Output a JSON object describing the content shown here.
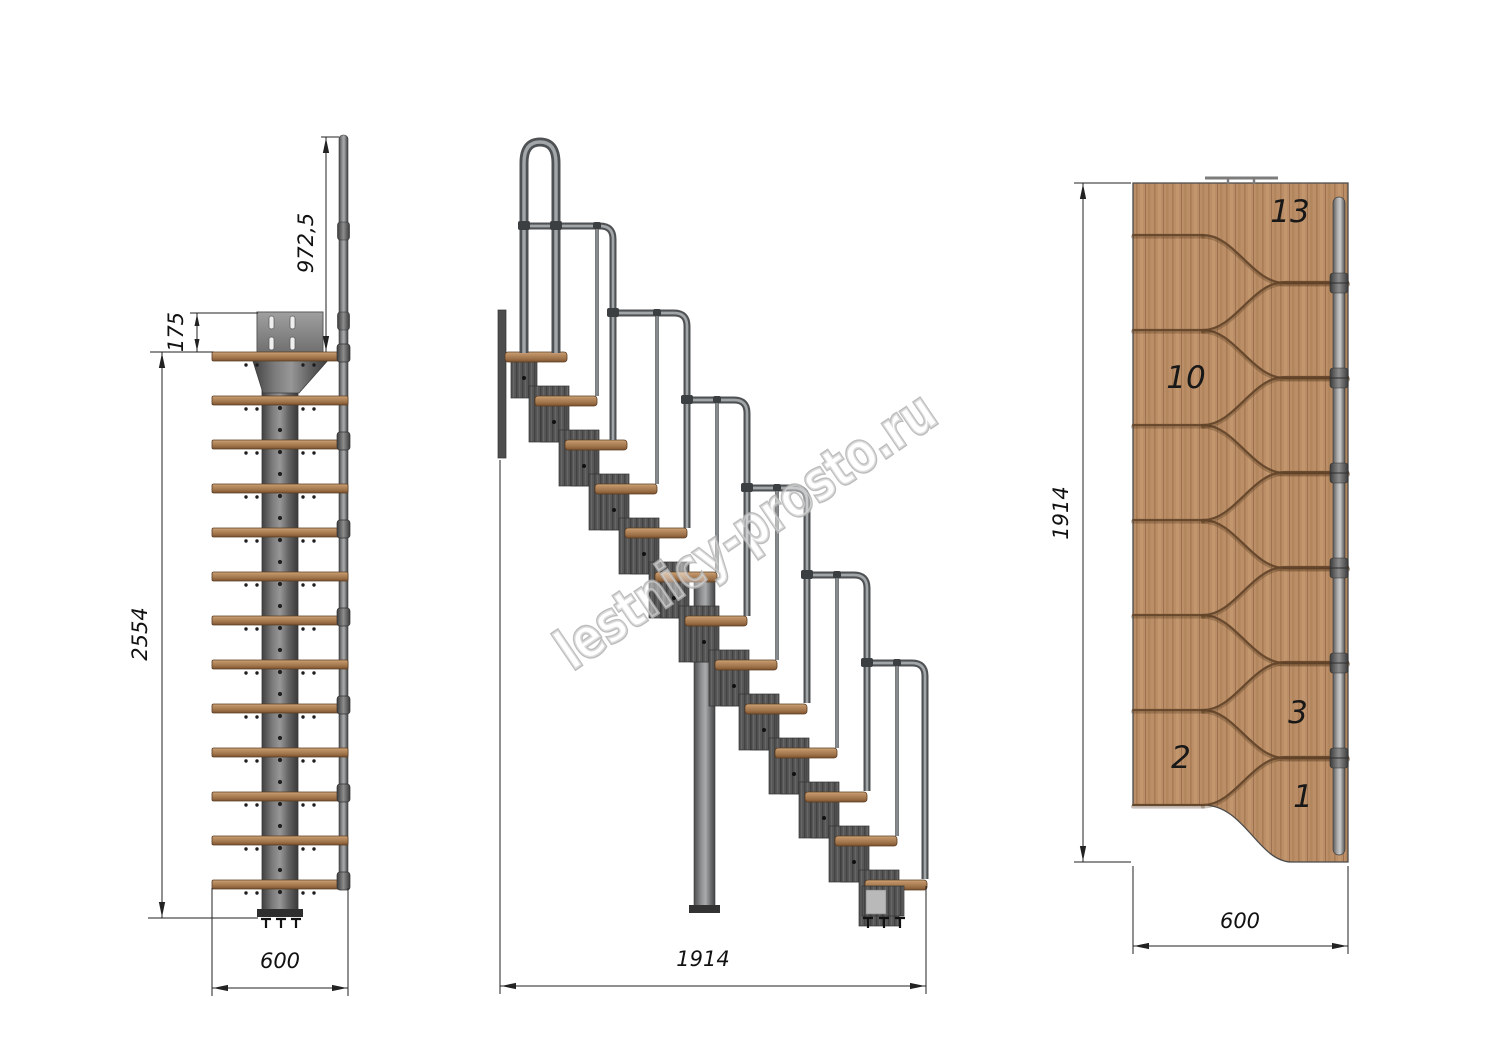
{
  "watermark": {
    "text": "lestnicy-prosto.ru"
  },
  "front_view": {
    "tread_count": 13,
    "dimensions": {
      "handrail_height": "972,5",
      "bracket_offset": "175",
      "total_height": "2554",
      "width": "600"
    }
  },
  "side_view": {
    "tread_count": 13,
    "dimensions": {
      "run_length": "1914"
    }
  },
  "plan_view": {
    "tread_count": 13,
    "tread_numbers": [
      "13",
      "10",
      "3",
      "2",
      "1"
    ],
    "dimensions": {
      "run_length": "1914",
      "width": "600"
    }
  },
  "colors": {
    "wood": "#b58a5e",
    "wood_plan": "#bb8e67",
    "wood_groove": "#63452a",
    "metal_tube": "#8f9193",
    "module_gray": "#555555",
    "plate_gray": "#8f8f8f",
    "dimension": "#1a1a1a",
    "watermark_outline": "#b2b2b2"
  }
}
